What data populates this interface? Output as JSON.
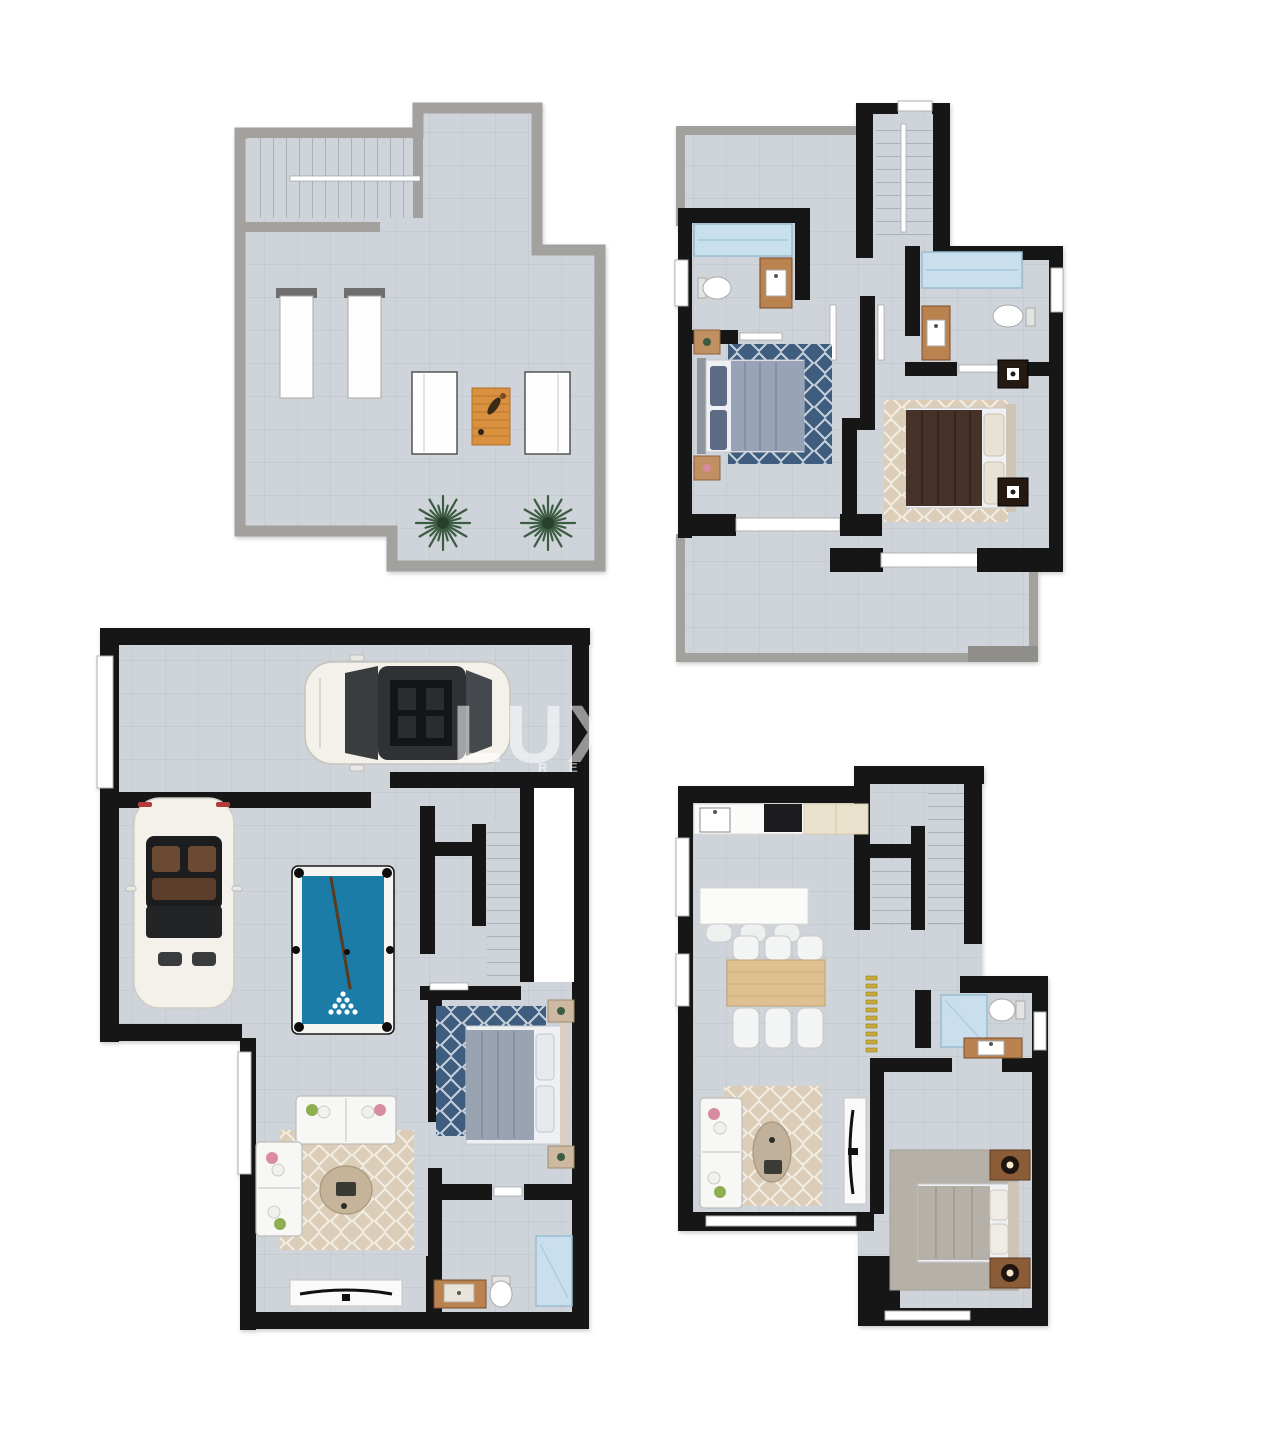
{
  "watermark": {
    "line1": "LUX",
    "line2": "R E A"
  },
  "colors": {
    "canvas-bg": "#ffffff",
    "wall-black": "#161616",
    "wall-gray": "#a3a19e",
    "wall-gray-dark": "#908e8b",
    "floor-tile": "#cfd4da",
    "tile-line": "#a9b2bc",
    "rug-blue": "#3e5d7f",
    "rug-beige": "#dbcdb8",
    "rug-gray": "#b6b1a8",
    "pool-felt": "#1b7ca8",
    "glass-blue": "#c9dfee",
    "window-frame": "#b0b0ae",
    "wood": "#b9824f",
    "wood-light": "#dec091",
    "wood-dark": "#8a5c38",
    "sofa-white": "#f7f7f5",
    "bed-dark-brown": "#463229",
    "accent-yellow": "#c9a93c",
    "plant-green": "#3c5c42",
    "car-white": "#f3f1ea",
    "watermark-color": "rgba(255,255,255,0.55)"
  },
  "plans": [
    {
      "id": "roof-terrace",
      "items": [
        "staircase",
        "handrail",
        "sun-loungers",
        "lounge-chairs",
        "wooden-table",
        "palm-plants"
      ]
    },
    {
      "id": "bedroom-floor",
      "items": [
        "staircase",
        "bathroom-1",
        "shower",
        "toilet",
        "vanity",
        "bed-1",
        "blue-rug",
        "nightstands",
        "bathroom-2",
        "bed-2",
        "beige-rug",
        "terrace"
      ]
    },
    {
      "id": "garage-floor",
      "items": [
        "sedan-car",
        "convertible-car",
        "pool-table",
        "staircase",
        "bed",
        "blue-rug",
        "sofa-set",
        "coffee-table",
        "tv-console",
        "bathroom"
      ]
    },
    {
      "id": "ground-floor",
      "items": [
        "kitchen-counter",
        "kitchen-island",
        "bar-stools",
        "dining-table",
        "staircase",
        "bathroom",
        "sofa",
        "beige-rug",
        "coffee-table",
        "tv-console",
        "bed",
        "nightstands"
      ]
    }
  ]
}
